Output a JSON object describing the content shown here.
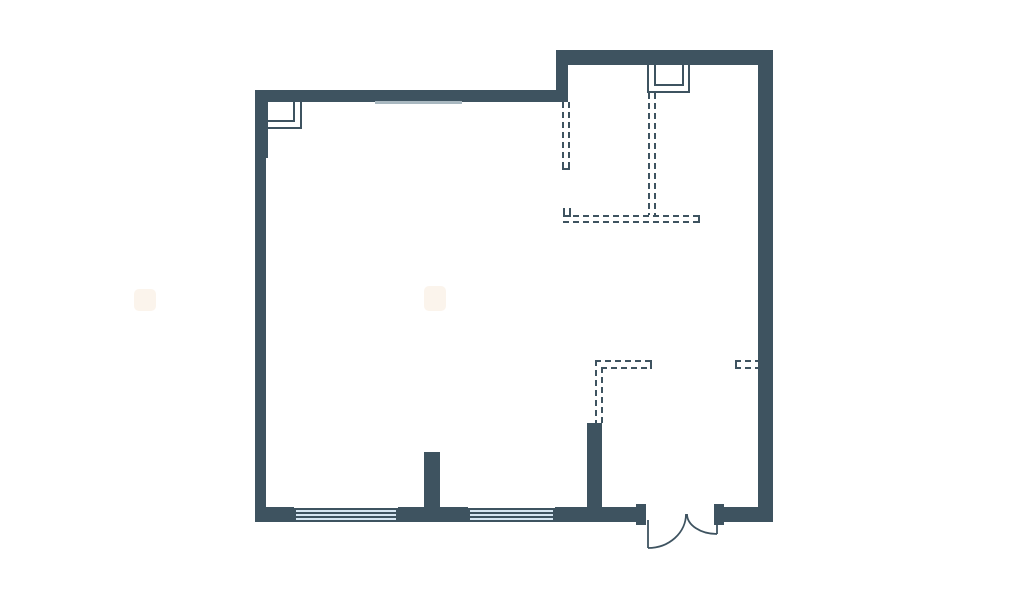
{
  "page": {
    "type": "architectural floor plan drawing",
    "visible_text": []
  },
  "colors": {
    "background": "#ffffff",
    "wall": "#3e5360",
    "glass": "#d7e7f3",
    "glass_line": "#3e5360",
    "opening_line": "#a9b8c0",
    "watermark": "#fbf4ec"
  },
  "plan": {
    "solid_walls": "dark slate exterior walls with stepped top edge, two interior wall stubs at bottom",
    "dashed_partitions": "double dashed lines marking partition walls: upper-right room outline, lower-middle L-shaped partition, short stub at right wall",
    "windows_count": 2,
    "window_style": "light blue triple-line glazing in bottom wall",
    "door": "double-leaf swing door with two quarter-circle arcs, bottom right",
    "duct_shafts_count": 2,
    "duct_shaft_style": "nested thin-line rectangles open to wall (top-left corner, top-middle-right)",
    "watermarks_count": 2
  }
}
